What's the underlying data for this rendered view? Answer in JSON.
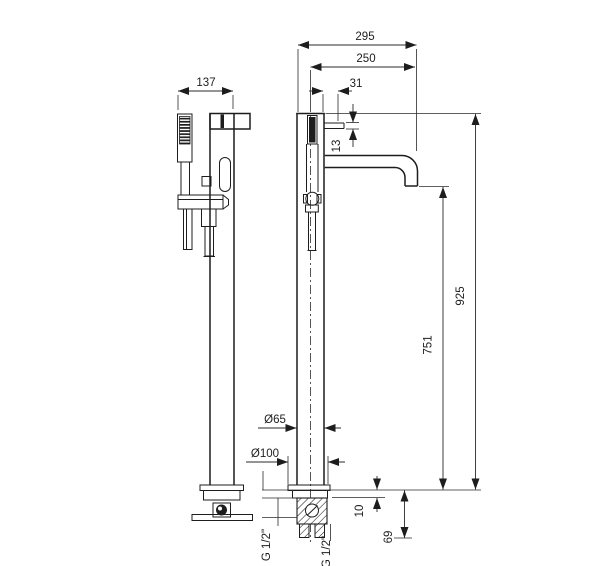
{
  "drawing": {
    "dims": {
      "side_width": "137",
      "total_reach": "295",
      "spout_reach": "250",
      "handle_offset": "31",
      "spout_section": "13",
      "total_height": "925",
      "spout_height": "751",
      "column_diameter": "Ø65",
      "base_diameter": "Ø100",
      "plate_thickness": "10",
      "underfloor_depth": "69",
      "inlet_left": "G 1/2\"",
      "inlet_right": "G 1/2\""
    },
    "colors": {
      "line": "#1d1d1d",
      "background": "#ffffff"
    }
  }
}
